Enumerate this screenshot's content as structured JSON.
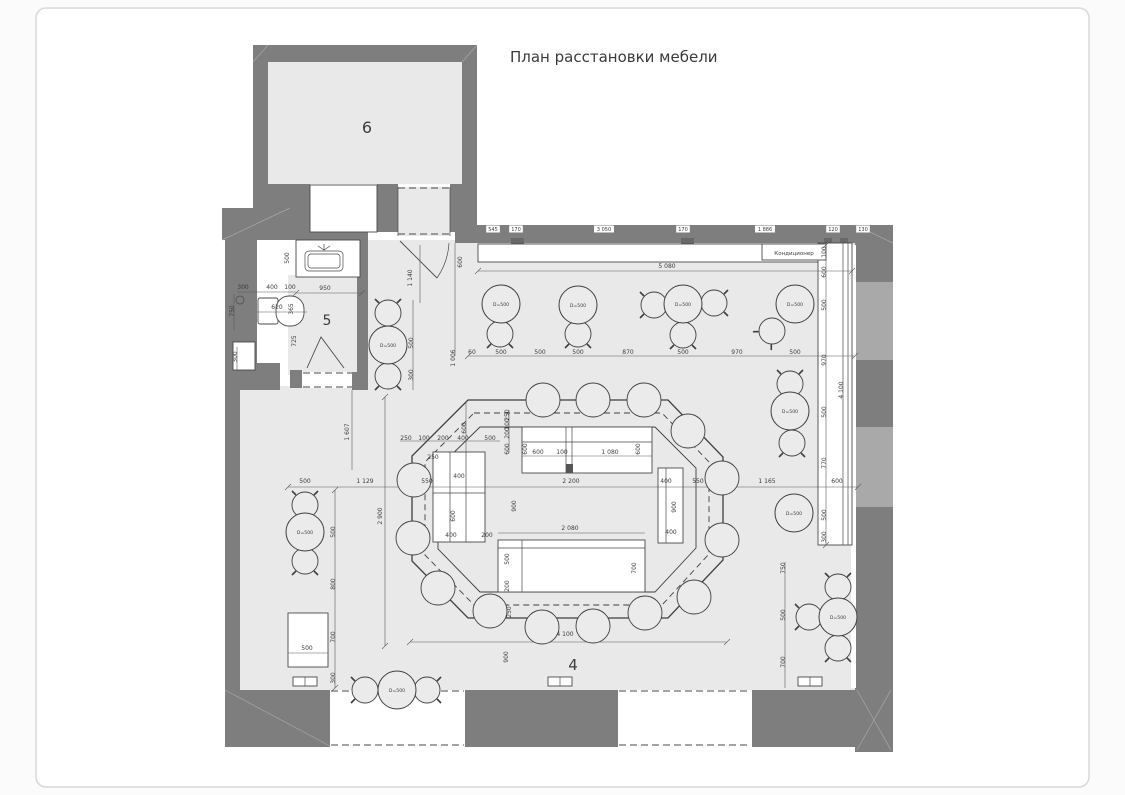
{
  "page": {
    "title": "План расстановки мебели"
  },
  "colors": {
    "wall": "#7e7e7e",
    "wall_dark": "#686868",
    "floor": "#e9e9e9",
    "window": "#a9a9a9",
    "line": "#4a4a4a",
    "dim_text": "#3c3c3c",
    "page_border": "#d9d9d9",
    "white": "#ffffff"
  },
  "rooms": [
    {
      "number": "6",
      "x": 367,
      "y": 133,
      "size": 16
    },
    {
      "number": "5",
      "x": 327,
      "y": 325,
      "size": 14
    },
    {
      "number": "4",
      "x": 573,
      "y": 670,
      "size": 15
    }
  ],
  "ac_unit": {
    "label": "Кондиционер"
  },
  "table_label": "D=500",
  "tables": [
    {
      "x": 501,
      "y": 304
    },
    {
      "x": 578,
      "y": 305
    },
    {
      "x": 683,
      "y": 304
    },
    {
      "x": 795,
      "y": 304
    },
    {
      "x": 388,
      "y": 345
    },
    {
      "x": 790,
      "y": 411
    },
    {
      "x": 794,
      "y": 513
    },
    {
      "x": 838,
      "y": 617
    },
    {
      "x": 305,
      "y": 532
    },
    {
      "x": 397,
      "y": 690
    }
  ],
  "chairs": [
    {
      "x": 500,
      "y": 334,
      "rot": 180
    },
    {
      "x": 578,
      "y": 334,
      "rot": 180
    },
    {
      "x": 654,
      "y": 305,
      "rot": 270
    },
    {
      "x": 714,
      "y": 303,
      "rot": 90
    },
    {
      "x": 683,
      "y": 335,
      "rot": 180
    },
    {
      "x": 772,
      "y": 331,
      "rot": 225
    },
    {
      "x": 388,
      "y": 313,
      "rot": 0
    },
    {
      "x": 388,
      "y": 376,
      "rot": 180
    },
    {
      "x": 790,
      "y": 384,
      "rot": 0
    },
    {
      "x": 792,
      "y": 443,
      "rot": 180
    },
    {
      "x": 838,
      "y": 587,
      "rot": 0
    },
    {
      "x": 809,
      "y": 617,
      "rot": 270
    },
    {
      "x": 838,
      "y": 648,
      "rot": 180
    },
    {
      "x": 305,
      "y": 505,
      "rot": 0
    },
    {
      "x": 305,
      "y": 561,
      "rot": 180
    },
    {
      "x": 365,
      "y": 690,
      "rot": 270
    },
    {
      "x": 427,
      "y": 690,
      "rot": 90
    }
  ],
  "stools": [
    {
      "x": 543,
      "y": 400
    },
    {
      "x": 593,
      "y": 400
    },
    {
      "x": 644,
      "y": 400
    },
    {
      "x": 688,
      "y": 431
    },
    {
      "x": 722,
      "y": 478
    },
    {
      "x": 722,
      "y": 540
    },
    {
      "x": 694,
      "y": 597
    },
    {
      "x": 645,
      "y": 613
    },
    {
      "x": 593,
      "y": 626
    },
    {
      "x": 542,
      "y": 627
    },
    {
      "x": 490,
      "y": 611
    },
    {
      "x": 438,
      "y": 588
    },
    {
      "x": 413,
      "y": 538
    },
    {
      "x": 414,
      "y": 480
    }
  ],
  "wall_chips": {
    "y": 231,
    "items": [
      {
        "t": "545",
        "x": 493
      },
      {
        "t": "170",
        "x": 516
      },
      {
        "t": "3 050",
        "x": 604
      },
      {
        "t": "170",
        "x": 683
      },
      {
        "t": "1 886",
        "x": 765
      },
      {
        "t": "120",
        "x": 833
      },
      {
        "t": "130",
        "x": 863
      }
    ]
  },
  "dims": [
    {
      "t": "5 080",
      "x": 667,
      "y": 268,
      "r": 0
    },
    {
      "t": "600",
      "x": 462,
      "y": 262,
      "r": 1
    },
    {
      "t": "60",
      "x": 472,
      "y": 354,
      "r": 0
    },
    {
      "t": "500",
      "x": 501,
      "y": 354,
      "r": 0
    },
    {
      "t": "500",
      "x": 540,
      "y": 354,
      "r": 0
    },
    {
      "t": "500",
      "x": 578,
      "y": 354,
      "r": 0
    },
    {
      "t": "870",
      "x": 628,
      "y": 354,
      "r": 0
    },
    {
      "t": "500",
      "x": 683,
      "y": 354,
      "r": 0
    },
    {
      "t": "970",
      "x": 737,
      "y": 354,
      "r": 0
    },
    {
      "t": "500",
      "x": 795,
      "y": 354,
      "r": 0
    },
    {
      "t": "1 006",
      "x": 455,
      "y": 358,
      "r": 1
    },
    {
      "t": "100",
      "x": 826,
      "y": 252,
      "r": 1
    },
    {
      "t": "600",
      "x": 826,
      "y": 272,
      "r": 1
    },
    {
      "t": "500",
      "x": 826,
      "y": 305,
      "r": 1
    },
    {
      "t": "970",
      "x": 826,
      "y": 360,
      "r": 1
    },
    {
      "t": "500",
      "x": 826,
      "y": 412,
      "r": 1
    },
    {
      "t": "770",
      "x": 826,
      "y": 463,
      "r": 1
    },
    {
      "t": "500",
      "x": 826,
      "y": 515,
      "r": 1
    },
    {
      "t": "300",
      "x": 826,
      "y": 537,
      "r": 1
    },
    {
      "t": "4 100",
      "x": 843,
      "y": 390,
      "r": 1
    },
    {
      "t": "750",
      "x": 785,
      "y": 568,
      "r": 1
    },
    {
      "t": "500",
      "x": 785,
      "y": 615,
      "r": 1
    },
    {
      "t": "700",
      "x": 785,
      "y": 662,
      "r": 1
    },
    {
      "t": "4 100",
      "x": 565,
      "y": 636,
      "r": 0
    },
    {
      "t": "900",
      "x": 508,
      "y": 657,
      "r": 1
    },
    {
      "t": "500",
      "x": 335,
      "y": 532,
      "r": 1
    },
    {
      "t": "800",
      "x": 335,
      "y": 584,
      "r": 1
    },
    {
      "t": "700",
      "x": 335,
      "y": 637,
      "r": 1
    },
    {
      "t": "300",
      "x": 335,
      "y": 678,
      "r": 1
    },
    {
      "t": "2 900",
      "x": 382,
      "y": 516,
      "r": 1
    },
    {
      "t": "1 607",
      "x": 349,
      "y": 432,
      "r": 1
    },
    {
      "t": "500",
      "x": 305,
      "y": 483,
      "r": 0
    },
    {
      "t": "1 129",
      "x": 365,
      "y": 483,
      "r": 0
    },
    {
      "t": "550",
      "x": 427,
      "y": 483,
      "r": 0
    },
    {
      "t": "2 200",
      "x": 571,
      "y": 483,
      "r": 0
    },
    {
      "t": "400",
      "x": 666,
      "y": 483,
      "r": 0
    },
    {
      "t": "550",
      "x": 698,
      "y": 483,
      "r": 0
    },
    {
      "t": "1 165",
      "x": 767,
      "y": 483,
      "r": 0
    },
    {
      "t": "600",
      "x": 837,
      "y": 483,
      "r": 0
    },
    {
      "t": "600",
      "x": 538,
      "y": 454,
      "r": 0
    },
    {
      "t": "100",
      "x": 562,
      "y": 454,
      "r": 0
    },
    {
      "t": "1 080",
      "x": 610,
      "y": 454,
      "r": 0
    },
    {
      "t": "600",
      "x": 527,
      "y": 449,
      "r": 1
    },
    {
      "t": "600",
      "x": 640,
      "y": 449,
      "r": 1
    },
    {
      "t": "250",
      "x": 509,
      "y": 415,
      "r": 1
    },
    {
      "t": "100",
      "x": 509,
      "y": 424,
      "r": 1
    },
    {
      "t": "200",
      "x": 509,
      "y": 433,
      "r": 1
    },
    {
      "t": "600",
      "x": 509,
      "y": 449,
      "r": 1
    },
    {
      "t": "250",
      "x": 406,
      "y": 440,
      "r": 0
    },
    {
      "t": "100",
      "x": 424,
      "y": 440,
      "r": 0
    },
    {
      "t": "200",
      "x": 443,
      "y": 440,
      "r": 0
    },
    {
      "t": "400",
      "x": 463,
      "y": 440,
      "r": 0
    },
    {
      "t": "500",
      "x": 490,
      "y": 440,
      "r": 0
    },
    {
      "t": "250",
      "x": 433,
      "y": 459,
      "r": 0
    },
    {
      "t": "400",
      "x": 459,
      "y": 478,
      "r": 0
    },
    {
      "t": "600",
      "x": 455,
      "y": 516,
      "r": 1
    },
    {
      "t": "400",
      "x": 451,
      "y": 537,
      "r": 0
    },
    {
      "t": "200",
      "x": 487,
      "y": 537,
      "r": 0
    },
    {
      "t": "900",
      "x": 516,
      "y": 506,
      "r": 1
    },
    {
      "t": "900",
      "x": 676,
      "y": 507,
      "r": 1
    },
    {
      "t": "400",
      "x": 671,
      "y": 534,
      "r": 0
    },
    {
      "t": "2 080",
      "x": 570,
      "y": 530,
      "r": 0
    },
    {
      "t": "500",
      "x": 509,
      "y": 559,
      "r": 1
    },
    {
      "t": "700",
      "x": 636,
      "y": 568,
      "r": 1
    },
    {
      "t": "200",
      "x": 509,
      "y": 586,
      "r": 1
    },
    {
      "t": "250",
      "x": 511,
      "y": 612,
      "r": 1
    },
    {
      "t": "600",
      "x": 466,
      "y": 428,
      "r": 1
    },
    {
      "t": "950",
      "x": 325,
      "y": 290,
      "r": 0
    },
    {
      "t": "500",
      "x": 289,
      "y": 258,
      "r": 1
    },
    {
      "t": "300",
      "x": 243,
      "y": 289,
      "r": 0
    },
    {
      "t": "400",
      "x": 272,
      "y": 289,
      "r": 0
    },
    {
      "t": "100",
      "x": 290,
      "y": 289,
      "r": 0
    },
    {
      "t": "750",
      "x": 234,
      "y": 311,
      "r": 1
    },
    {
      "t": "620",
      "x": 277,
      "y": 309,
      "r": 0
    },
    {
      "t": "365",
      "x": 293,
      "y": 309,
      "r": 1
    },
    {
      "t": "725",
      "x": 296,
      "y": 341,
      "r": 1
    },
    {
      "t": "300",
      "x": 237,
      "y": 357,
      "r": 1
    },
    {
      "t": "1 140",
      "x": 412,
      "y": 278,
      "r": 1
    },
    {
      "t": "500",
      "x": 413,
      "y": 343,
      "r": 1
    },
    {
      "t": "300",
      "x": 413,
      "y": 375,
      "r": 1
    },
    {
      "t": "500",
      "x": 307,
      "y": 650,
      "r": 0
    }
  ]
}
